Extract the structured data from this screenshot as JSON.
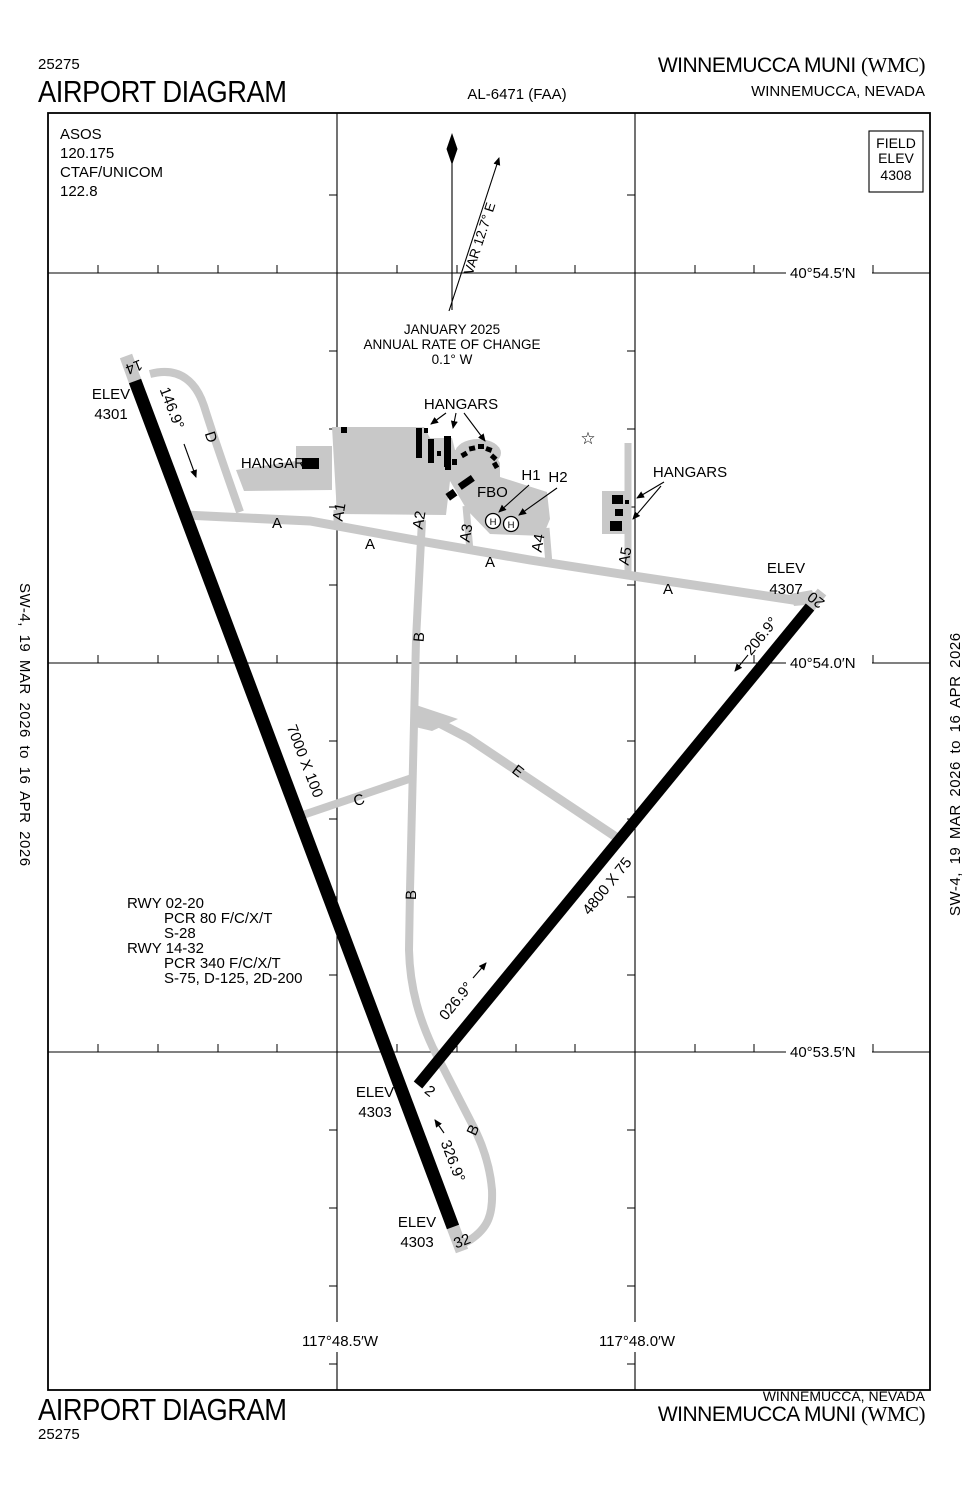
{
  "header": {
    "procedure_number": "25275",
    "title": "AIRPORT DIAGRAM",
    "chart_id": "AL-6471 (FAA)",
    "airport_name": "WINNEMUCCA MUNI",
    "airport_code": "(WMC)",
    "city": "WINNEMUCCA, NEVADA"
  },
  "footer": {
    "procedure_number": "25275",
    "title": "AIRPORT DIAGRAM",
    "airport_name": "WINNEMUCCA MUNI",
    "airport_code": "(WMC)",
    "city": "WINNEMUCCA, NEVADA"
  },
  "margins": {
    "left": "SW-4,  19 MAR 2026  to  16 APR 2026",
    "right": "SW-4,  19 MAR 2026  to  16 APR 2026"
  },
  "map": {
    "info": {
      "l1": "ASOS",
      "l2": "120.175",
      "l3": "CTAF/UNICOM",
      "l4": "122.8"
    },
    "field_elev": {
      "l1": "FIELD",
      "l2": "ELEV",
      "l3": "4308"
    },
    "compass": {
      "var": "VAR 12.7° E",
      "l1": "JANUARY 2025",
      "l2": "ANNUAL RATE OF CHANGE",
      "l3": "0.1° W"
    },
    "lat": [
      "40°54.5′N",
      "40°54.0′N",
      "40°53.5′N"
    ],
    "lon": [
      "117°48.5′W",
      "117°48.0′W"
    ],
    "elev_label": "ELEV",
    "elevs": {
      "rw14": "4301",
      "rw20": "4307",
      "rw2": "4303",
      "rw32": "4303"
    },
    "rwy_nums": {
      "r14": "14",
      "r32": "32",
      "r2": "2",
      "r20": "20"
    },
    "headings": {
      "h14": "146.9°",
      "h32": "326.9°",
      "h2": "026.9°",
      "h20": "206.9°"
    },
    "dims": {
      "rw1432": "7000 X 100",
      "rw0220": "4800 X 75"
    },
    "taxiways": {
      "a": "A",
      "b": "B",
      "c": "C",
      "d": "D",
      "e": "E",
      "a1": "A1",
      "a2": "A2",
      "a3": "A3",
      "a4": "A4",
      "a5": "A5"
    },
    "buildings": {
      "hangar": "HANGAR",
      "hangars": "HANGARS",
      "fbo": "FBO",
      "h1": "H1",
      "h2": "H2",
      "helipad": "H"
    },
    "beacon_glyph": "☆",
    "data_block": [
      "RWY 02-20",
      "PCR 80 F/C/X/T",
      "S-28",
      "RWY 14-32",
      "PCR 340 F/C/X/T",
      "S-75, D-125, 2D-200"
    ]
  }
}
